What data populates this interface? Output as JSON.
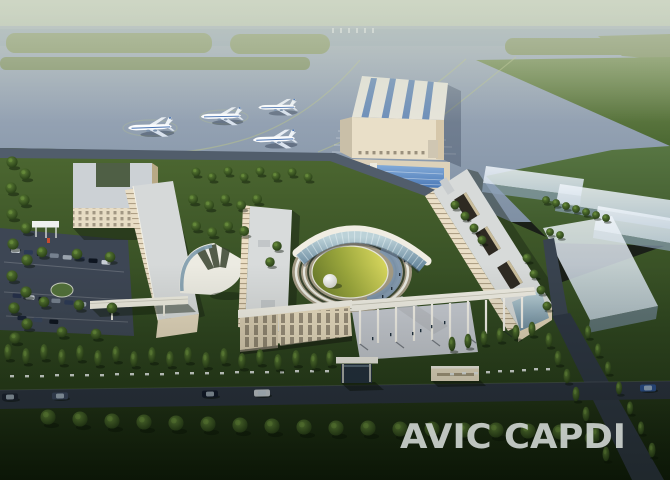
{
  "title": "AVIC CAPDI campus aerial rendering",
  "watermark": {
    "text": "AVIC CAPDI",
    "color": "#cbd1cd"
  },
  "scene": {
    "setting": "aerial architectural rendering of an office campus beside an airport apron at dusk",
    "airport": {
      "parked_airliners": 4,
      "elements": [
        "runway",
        "grass islands",
        "taxiway guide lines",
        "apron stand markings",
        "hangar with blue skylight roof"
      ]
    },
    "campus": {
      "elements": [
        "U-shaped office building",
        "west office slab",
        "central office slab",
        "east office slab with roof courtyards",
        "fan-shaped atrium roof",
        "crescent glass building",
        "circular lawn courtyard with concentric rings",
        "white dome pavilion",
        "water arc",
        "podium building",
        "pergola colonnade",
        "skybridge",
        "gatehouse",
        "signage wall",
        "parking canopy",
        "surface parking with cars",
        "tree-lined roads",
        "bollard light rows"
      ]
    },
    "future_phase": "translucent massing blocks on east lawn"
  },
  "palette": {
    "sky_haze": "#c3cdb9",
    "apron": "#8ea0b2",
    "field_green": "#4f6c38",
    "campus_green": "#33491f",
    "foreground_green": "#16240e",
    "building_cream": "#e9dfc8",
    "roof_gray": "#d6d9d9",
    "glass_blue": "#7e9cb2",
    "skylight_blue": "#5f87bb",
    "lawn_yellow": "#c9c94e",
    "road": "#2b3340",
    "watermark_gray": "#cbd1cd"
  }
}
